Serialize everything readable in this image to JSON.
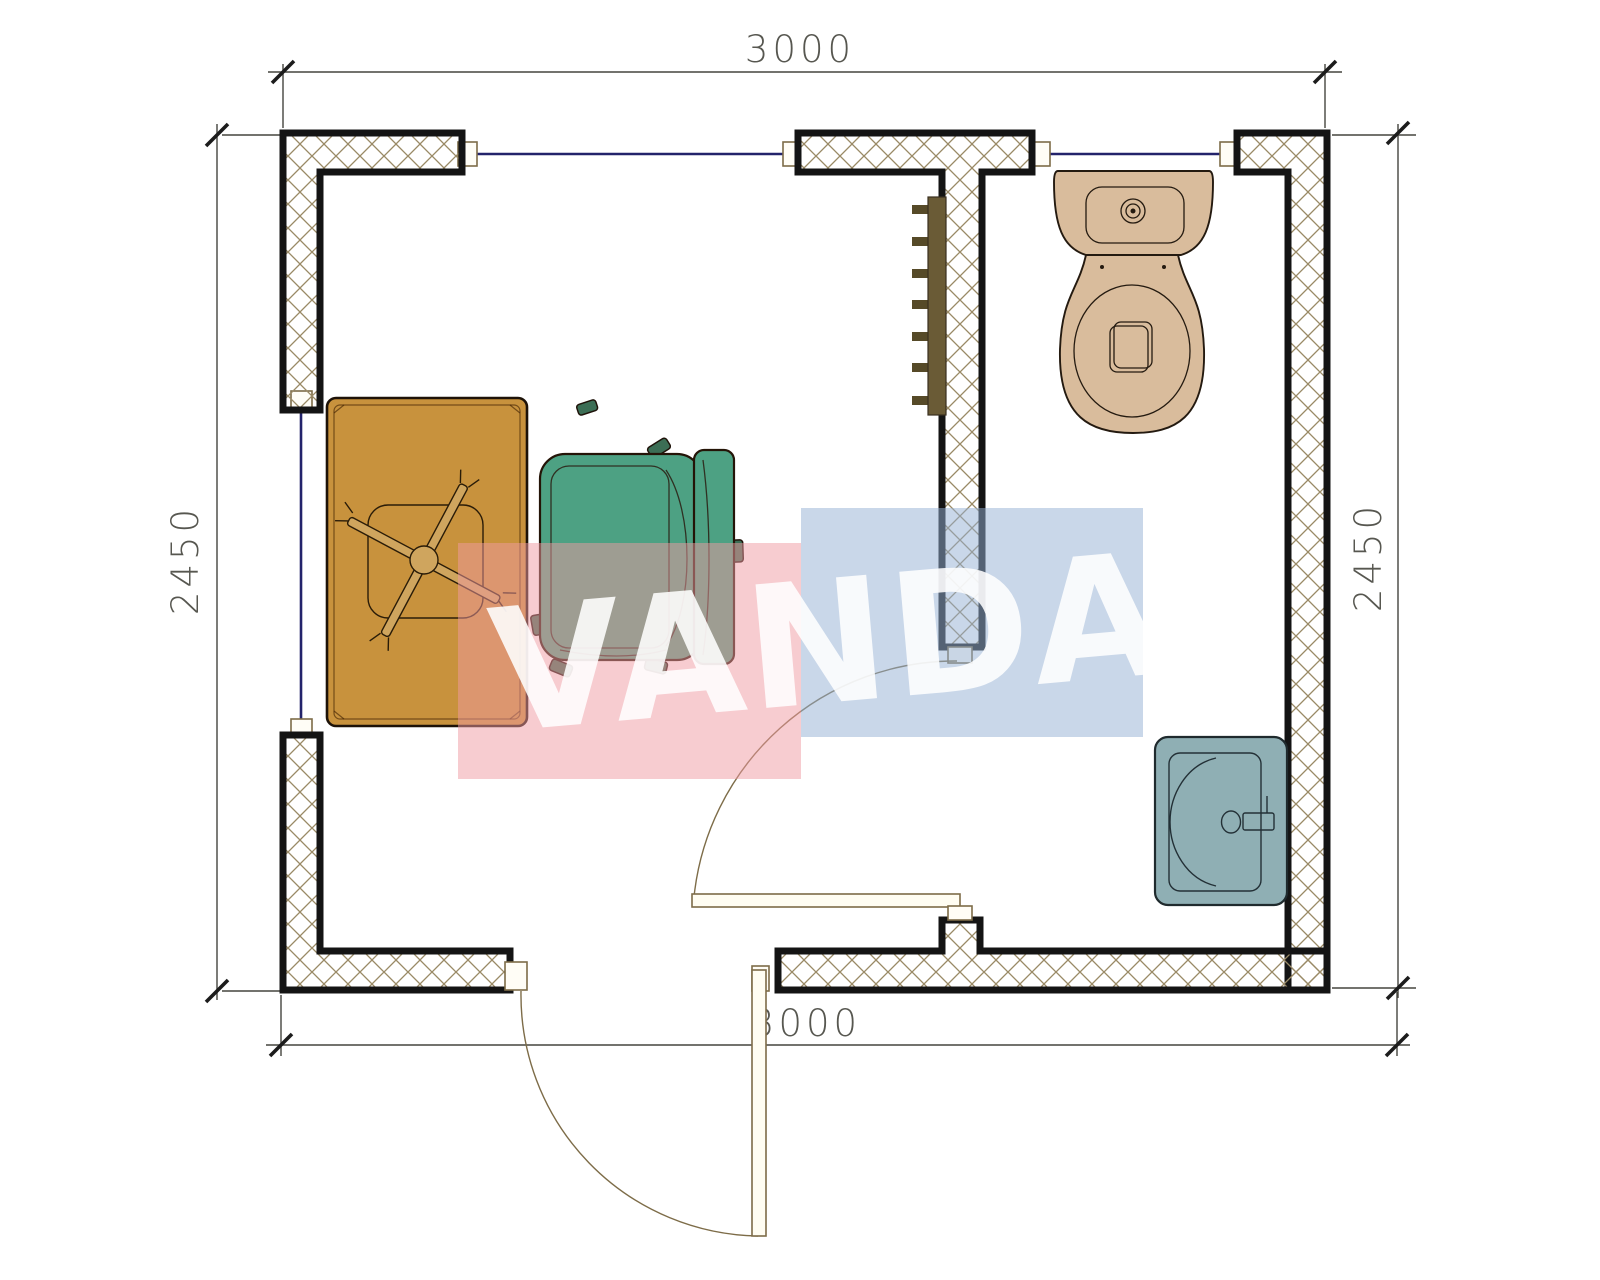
{
  "drawing": {
    "type": "floor-plan",
    "rooms": [
      "office",
      "wc"
    ],
    "fixtures": [
      "desk",
      "office-chair",
      "armchair",
      "radiator",
      "toilet",
      "sink",
      "entrance-door",
      "wc-door",
      "windows"
    ]
  },
  "dimensions": {
    "top": "3000",
    "bottom": "3000",
    "left": "2450",
    "right": "2450"
  },
  "watermark": {
    "text": "VANDA"
  },
  "colors": {
    "wall_outline": "#141414",
    "hatch_line": "#9a8a66",
    "dimension": "#45453e",
    "window": "#23236b",
    "door": "#7d6c48",
    "door_leaf_fill": "#fffdf2",
    "jamb_fill": "#fffdf6",
    "desk": "#c8923d",
    "chair": "#4da183",
    "chair_dark": "#3c6e55",
    "toilet": "#d9bc9c",
    "sink": "#8fafb4",
    "radiator": "#6a5b36",
    "radiator_fin": "#564a28",
    "wm_pink": "rgba(240,154,162,0.50)",
    "wm_blue": "rgba(148,175,212,0.50)",
    "wm_text": "#ffffff"
  }
}
